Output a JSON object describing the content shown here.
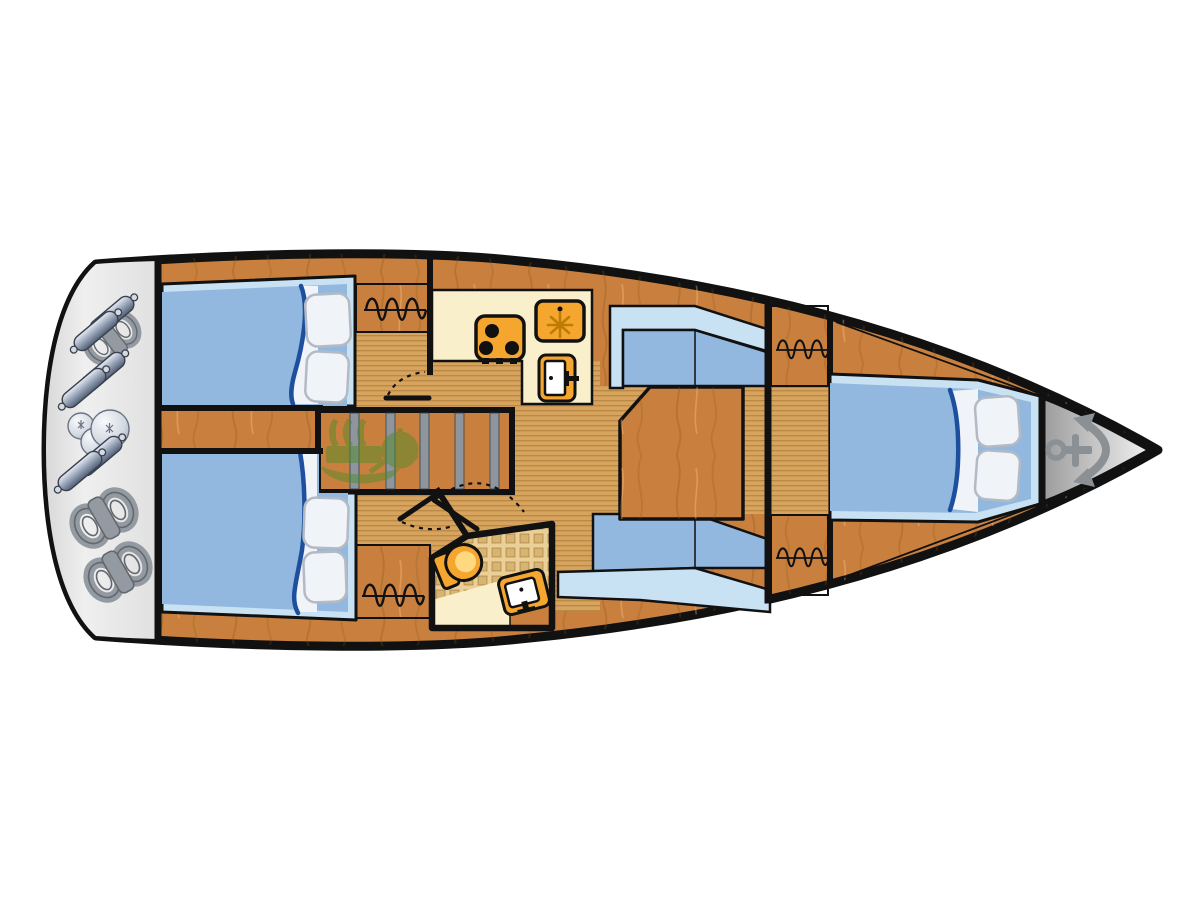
{
  "plan": {
    "type": "sailboat-interior-floor-plan",
    "orientation": "bow-right"
  },
  "colors": {
    "background": "#ffffff",
    "ink": "#111111",
    "wood": "#c9803e",
    "wood-grain": "#8a5210",
    "floor": "#d6a45c",
    "floor-line": "#6e3c0c",
    "cream": "#f9efcb",
    "appliance-orange": "#f4a62e",
    "appliance-accent": "#bf7c04",
    "bed-blue": "#92b8e0",
    "bed-blue-light": "#c9e2f3",
    "blanket-blue": "#1d4f9e",
    "linen-white": "#f0f3f7",
    "pillow-edge": "#b4bac4",
    "platform-gray": "#e7e7e7",
    "step-gray": "#8e959d",
    "tile-base": "#ead096",
    "tile-dot": "#b98a3c",
    "fender-edge": "#39404e",
    "rope": "#939aa2",
    "rope-dark": "#63686e",
    "anchor-gray": "#8b9095",
    "engine-green": "#4f8a2c",
    "toilet-bowl": "#ffd87f"
  },
  "areas": [
    "transom-fender-storage",
    "aft-cabin-port",
    "aft-cabin-starboard",
    "companionway-steps",
    "galley",
    "head-compartment",
    "salon",
    "forward-corridor",
    "forward-cabin",
    "anchor-locker"
  ],
  "icons": [
    "anchor-icon",
    "stove-icon",
    "fridge-icon",
    "oven-icon",
    "toilet-icon",
    "sink-icon",
    "hanger-rail-icon",
    "engine-watermark-icon",
    "fender-icon",
    "fender-ball-icon",
    "rope-coil-icon",
    "pillow-icon",
    "door-swing-icon"
  ]
}
